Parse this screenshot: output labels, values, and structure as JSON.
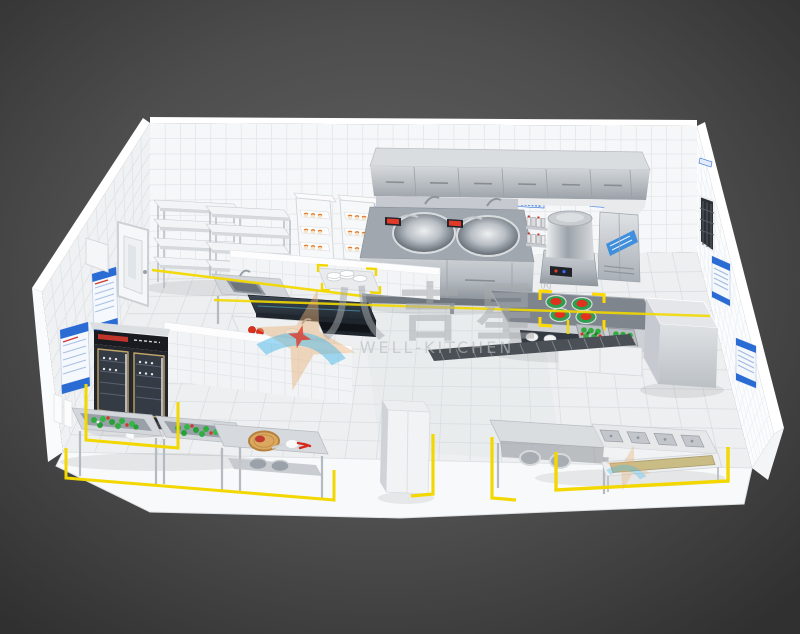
{
  "title": "3D isometric rendering of a commercial kitchen floor plan",
  "watermark": {
    "cn": "八吉星",
    "reg": "®",
    "en": "WELL-KITCHEN"
  },
  "palette": {
    "background_center": "#616161",
    "background_edge": "#323232",
    "wall_tile": "#f5f6f8",
    "floor_tile": "#eef0f1",
    "grout": "#d8dbdf",
    "stainless_light": "#d4d7da",
    "stainless_dark": "#969da4",
    "floor_marking_yellow": "#f2d800",
    "sign_blue": "#2a6bd4",
    "tomato_red": "#e1301e",
    "vegetable_green": "#2fae3e",
    "freezer_black": "#1d2026",
    "gold_trim": "#c0a369",
    "wood_board": "#d9a660",
    "logo_orange": "#e9b278",
    "logo_blue": "#49b8e8"
  },
  "room": {
    "walls": "white ceramic tile",
    "floor": "light marble tile",
    "markings": "yellow equipment zone lines"
  },
  "equipment": [
    "exhaust-hood",
    "double-wok-range",
    "seasoning-rack",
    "soup-pot-cooker",
    "sterilizer-cabinet",
    "wall-vent",
    "storage-shelving",
    "bun-steamer-racks",
    "plate-stacks",
    "prep-sink-table",
    "dark-top-counter",
    "tomato-prep-counter",
    "tile-partitions",
    "island-counter",
    "tomato-plates",
    "vegetable-crates",
    "walk-in-cooler",
    "glass-door-freezer",
    "vegetable-wash-sinks",
    "cutting-board-table",
    "tall-white-cabinet",
    "pot-table",
    "four-compartment-sink",
    "pot-rack-table",
    "floor-drain-grate",
    "entry-door",
    "wall-posters",
    "floor-markings"
  ],
  "signs": {
    "back_wall_label_count": 5,
    "left_wall_posters": 2,
    "right_wall_posters": 2,
    "right_wall_vents": 1
  }
}
